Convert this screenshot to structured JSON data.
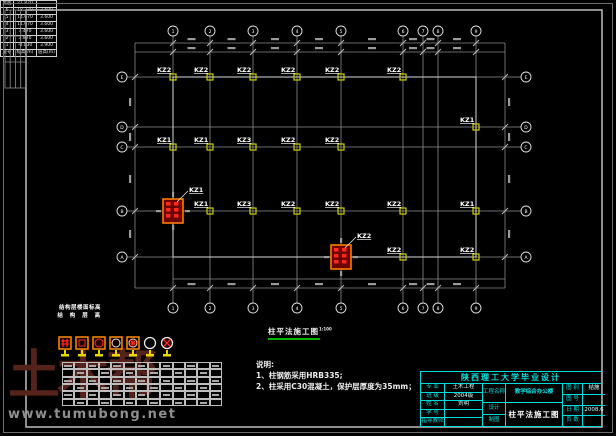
{
  "watermark": {
    "site": "www.tumubong.net",
    "logo": "土木帮"
  },
  "plan": {
    "caption": "柱平法施工图",
    "scale": "1:100",
    "top_axes": [
      "1",
      "2",
      "3",
      "4",
      "5",
      "6",
      "7",
      "8",
      "9"
    ],
    "bottom_axes": [
      "1",
      "2",
      "3",
      "4",
      "5",
      "6",
      "7",
      "8",
      "9"
    ],
    "left_axes": [
      "E",
      "D",
      "C",
      "B",
      "A"
    ],
    "right_axes": [
      "E",
      "D",
      "C",
      "B",
      "A"
    ],
    "kz_labels": [
      "KZ2",
      "KZ2",
      "KZ2",
      "KZ2",
      "KZ2",
      "KZ2",
      "KZ1",
      "KZ1",
      "KZ1",
      "KZ3",
      "KZ2",
      "KZ2",
      "KZ1",
      "KZ3",
      "KZ2",
      "KZ2",
      "KZ2",
      "KZ1",
      "KZ2",
      "KZ2"
    ],
    "red_flags": [
      "KZ1",
      "KZ2"
    ]
  },
  "storey_table": {
    "rows": [
      [
        "屋面",
        "21.870",
        ""
      ],
      [
        "6",
        "18.270",
        "3.600"
      ],
      [
        "5",
        "14.670",
        "3.600"
      ],
      [
        "4",
        "11.070",
        "3.600"
      ],
      [
        "3",
        "7.470",
        "3.600"
      ],
      [
        "2",
        "3.870",
        "3.600"
      ],
      [
        "1",
        "-0.030",
        "3.900"
      ],
      [
        "层号",
        "标高(m)",
        "层高(m)"
      ]
    ],
    "footer1": "结构层楼面标高",
    "footer2": "结 构 层 高"
  },
  "notes": {
    "title": "说明:",
    "item1": "1、柱钢筋采用HRB335;",
    "item2": "2、柱采用C30混凝土，保护层厚度为35mm；"
  },
  "title_block": {
    "header": "陕西理工大学毕业设计",
    "rows_left": [
      {
        "label": "专 业",
        "value": "土木工程"
      },
      {
        "label": "班 级",
        "value": "2004级"
      },
      {
        "label": "姓 名",
        "value": "刘明"
      },
      {
        "label": "学 号",
        "value": ""
      },
      {
        "label": "指导教师",
        "value": ""
      }
    ],
    "project_label": "工程名称",
    "design_label": "设计",
    "check_label": "制图",
    "project_name": "教学综合办公楼",
    "drawing_name": "柱平法施工图",
    "rows_right": [
      {
        "label": "图 别",
        "value": "结施"
      },
      {
        "label": "图 号",
        "value": ""
      },
      {
        "label": "日 期",
        "value": "2008.6"
      },
      {
        "label": "页 数",
        "value": ""
      }
    ]
  },
  "colors": {
    "accent_cyan": "#00dcdc",
    "grid_gray": "#8f8f8f",
    "column_yellow": "#cfcf00",
    "highlight_red": "#ff2a1a",
    "scale_green": "#00b400",
    "logo_red": "#55231b"
  }
}
